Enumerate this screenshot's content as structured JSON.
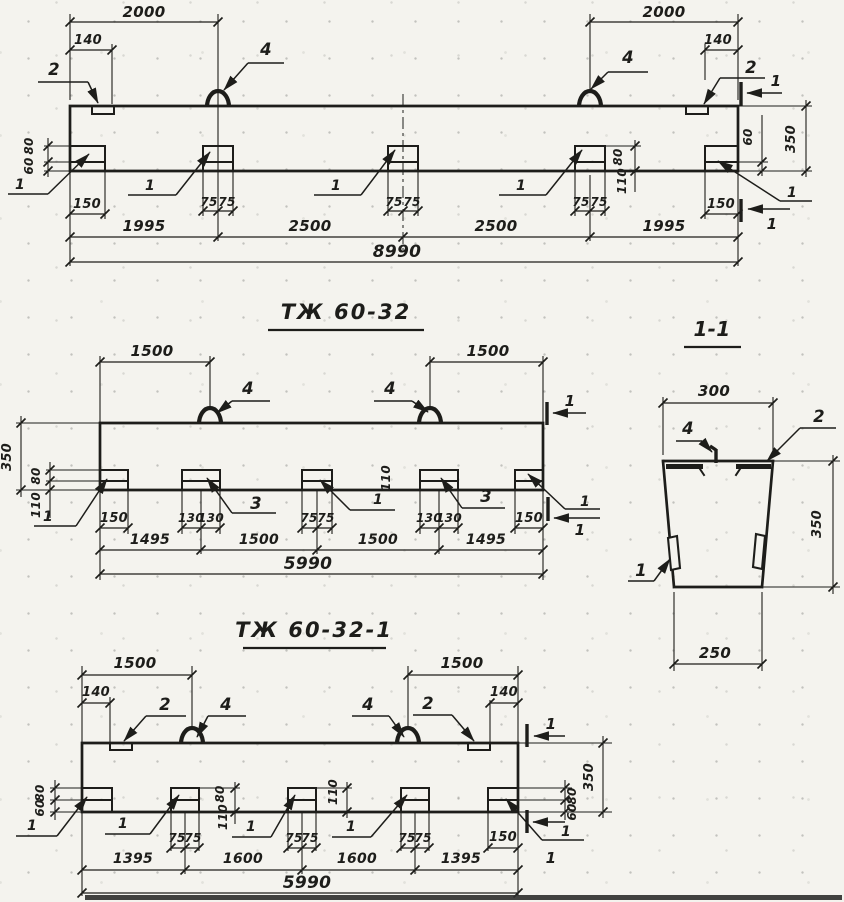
{
  "colors": {
    "ink": "#1d1d1a",
    "paper": "#f4f3ee"
  },
  "titles": {
    "middle_view": "ТЖ 60-32",
    "bottom_view": "ТЖ 60-32-1",
    "section_view": "1-1"
  },
  "callouts": {
    "n1": "1",
    "n2": "2",
    "n3": "3",
    "n4": "4"
  },
  "dims": {
    "v60": "60",
    "v75": "75",
    "v80": "80",
    "v110": "110",
    "v130": "130",
    "v140": "140",
    "v150": "150",
    "v250": "250",
    "v300": "300",
    "v350": "350",
    "v1395": "1395",
    "v1495": "1495",
    "v1500": "1500",
    "v1600": "1600",
    "v1995": "1995",
    "v2000": "2000",
    "v2500": "2500",
    "v5990": "5990",
    "v8990": "8990"
  }
}
